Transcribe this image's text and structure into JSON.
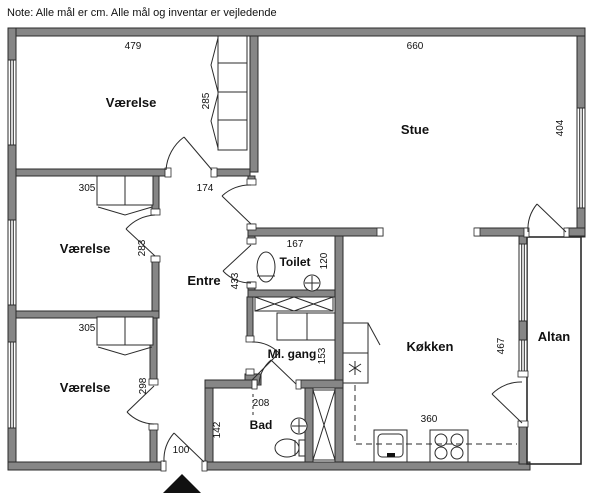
{
  "note": "Note: Alle mål er cm. Alle mål og inventar er vejledende",
  "colors": {
    "wall_fill": "#868686",
    "line": "#2b2b2b",
    "background": "#ffffff"
  },
  "rooms": {
    "vaerelse1": {
      "label": "Værelse",
      "width_cm": "479",
      "depth_cm": "285"
    },
    "stue": {
      "label": "Stue",
      "width_cm": "660",
      "depth_cm": "404"
    },
    "vaerelse2": {
      "label": "Værelse",
      "width_cm": "305",
      "depth_cm": "283"
    },
    "entre": {
      "label": "Entre",
      "height_cm": "433"
    },
    "toilet": {
      "label": "Toilet",
      "width_cm": "167",
      "depth_cm": "120"
    },
    "mlgang": {
      "label": "Ml. gang",
      "height_cm": "153"
    },
    "vaerelse3": {
      "label": "Værelse",
      "width_cm": "305",
      "depth_cm": "298"
    },
    "bad": {
      "label": "Bad",
      "width_cm": "208",
      "depth_cm": "142"
    },
    "koekken": {
      "label": "Køkken",
      "width_cm": "360",
      "depth_cm": "467"
    },
    "altan": {
      "label": "Altan"
    }
  },
  "measurements": {
    "hall_width_cm": "174",
    "entrance_door_cm": "100"
  }
}
